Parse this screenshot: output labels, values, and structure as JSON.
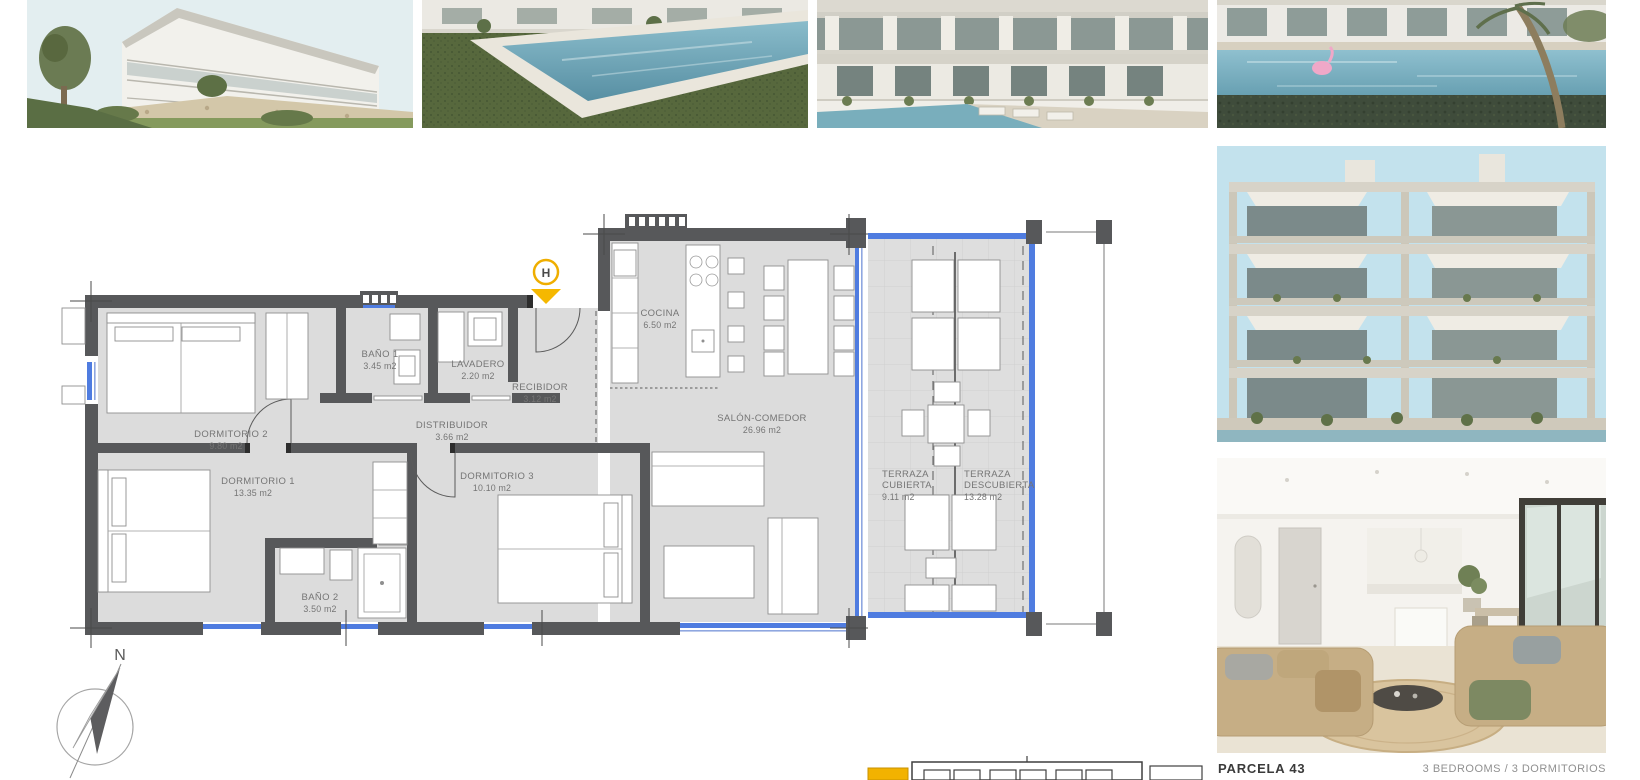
{
  "page": {
    "bg": "#ffffff"
  },
  "captions": {
    "parcel": "PARCELA 43",
    "bedrooms": "3 BEDROOMS / 3 DORMITORIOS"
  },
  "compass": {
    "north": "N"
  },
  "plan": {
    "entrance_marker": "H",
    "rooms": [
      {
        "name": "DORMITORIO 2",
        "area": "9.80 m2"
      },
      {
        "name": "BAÑO 1",
        "area": "3.45 m2"
      },
      {
        "name": "LAVADERO",
        "area": "2.20 m2"
      },
      {
        "name": "RECIBIDOR",
        "area": "3.12 m2"
      },
      {
        "name": "DISTRIBUIDOR",
        "area": "3.66 m2"
      },
      {
        "name": "COCINA",
        "area": "6.50 m2"
      },
      {
        "name": "SALÓN-COMEDOR",
        "area": "26.96 m2"
      },
      {
        "name": "DORMITORIO 1",
        "area": "13.35 m2"
      },
      {
        "name": "DORMITORIO 3",
        "area": "10.10 m2"
      },
      {
        "name": "BAÑO 2",
        "area": "3.50 m2"
      },
      {
        "name_lines": [
          "TERRAZA",
          "CUBIERTA"
        ],
        "area": "9.11 m2"
      },
      {
        "name_lines": [
          "TERRAZA",
          "DESCUBIERTA"
        ],
        "area": "13.28 m2"
      }
    ],
    "colors": {
      "wall": "#57585a",
      "glazing_blue": "#4f7ce0",
      "accent_yellow": "#f2b200",
      "room_fill": "#dcdcdc"
    }
  },
  "photos": [
    {
      "alt": "exterior-building-corner"
    },
    {
      "alt": "pool-corner-garden"
    },
    {
      "alt": "facade-terraces-pool"
    },
    {
      "alt": "pool-flamingo-building"
    },
    {
      "alt": "building-front-elevation"
    },
    {
      "alt": "interior-living-room"
    }
  ],
  "site_key": {
    "highlight_color": "#f2b200"
  }
}
